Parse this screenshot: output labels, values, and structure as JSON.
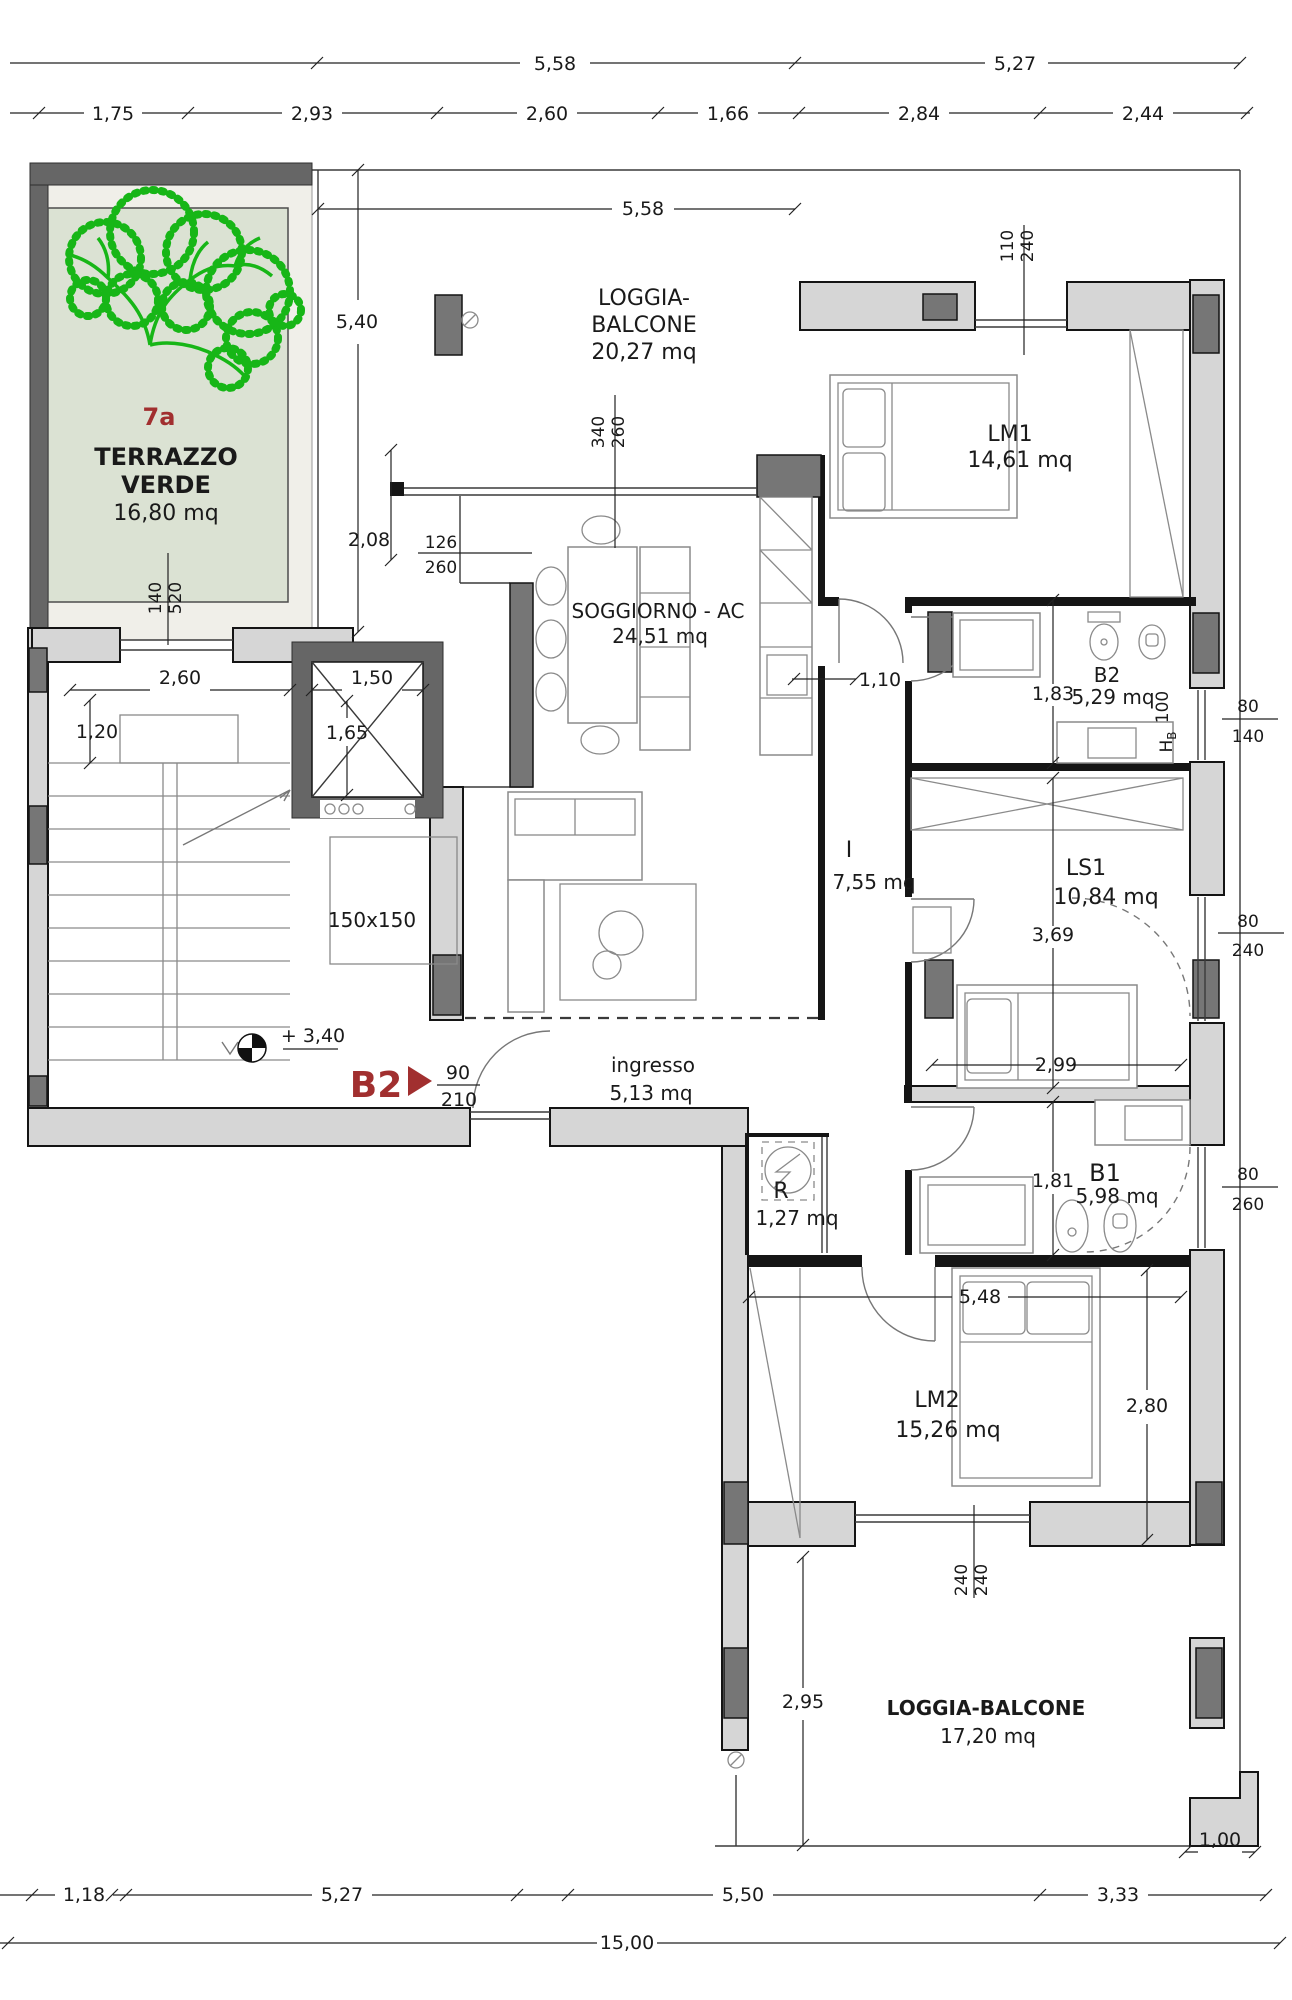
{
  "plan": {
    "unit": {
      "id": "7a"
    },
    "entry": {
      "label": "B2",
      "width": "90",
      "height": "210"
    },
    "level": {
      "value": "+ 3,40"
    },
    "landing": {
      "size": "150x150"
    },
    "rooms": {
      "terrazzo": {
        "id": "7a",
        "line1": "TERRAZZO",
        "line2": "VERDE",
        "area": "16,80 mq"
      },
      "loggia_top": {
        "line1": "LOGGIA-",
        "line2": "BALCONE",
        "area": "20,27 mq"
      },
      "lm1": {
        "name": "LM1",
        "area": "14,61 mq"
      },
      "soggiorno": {
        "name": "SOGGIORNO - AC",
        "area": "24,51 mq"
      },
      "b2": {
        "name": "B2",
        "area": "5,29 mq"
      },
      "corridoio": {
        "name": "I",
        "area": "7,55 mq"
      },
      "ls1": {
        "name": "LS1",
        "area": "10,84 mq"
      },
      "ingresso": {
        "name": "ingresso",
        "area": "5,13 mq"
      },
      "r": {
        "name": "R",
        "area": "1,27 mq"
      },
      "b1": {
        "name": "B1",
        "area": "5,98 mq"
      },
      "lm2": {
        "name": "LM2",
        "area": "15,26 mq"
      },
      "loggia_bottom": {
        "name": "LOGGIA-BALCONE",
        "area": "17,20 mq"
      }
    },
    "dims": {
      "top1": [
        "5,58",
        "5,27"
      ],
      "top2": [
        "1,75",
        "2,93",
        "2,60",
        "1,66",
        "2,84",
        "2,44"
      ],
      "bottom1": [
        "1,18",
        "5,27",
        "5,50",
        "3,33"
      ],
      "total": "15,00",
      "loggia_w": "5,58",
      "terrace_h": "5,40",
      "d208": "2,08",
      "stair_w": "2,60",
      "stair_h": "1,20",
      "elev_w": "1,50",
      "elev_h": "1,65",
      "d110": "1,10",
      "d183": "1,83",
      "d369": "3,69",
      "d299": "2,99",
      "d181": "1,81",
      "d548": "5,48",
      "d280": "2,80",
      "d295": "2,95",
      "d100": "1,00"
    },
    "windows": {
      "w140_520": {
        "a": "140",
        "b": "520"
      },
      "w340_260": {
        "a": "340",
        "b": "260"
      },
      "w126_260": {
        "a": "126",
        "b": "260"
      },
      "w110_240": {
        "a": "110",
        "b": "240"
      },
      "w80_140": {
        "a": "80",
        "b": "140"
      },
      "w80_240": {
        "a": "80",
        "b": "240"
      },
      "w80_260": {
        "a": "80",
        "b": "260"
      },
      "w240_240": {
        "a": "240",
        "b": "240"
      },
      "hb": {
        "h": "H",
        "sub": "B",
        "val": "100"
      }
    },
    "colors": {
      "wall_light": "#d6d6d6",
      "wall_dark": "#767676",
      "terrace_wall": "#666666",
      "green_fill": "#dbe2d3",
      "tree_green": "#17b617",
      "accent_red": "#a12f2f",
      "line": "#1a1a1a"
    }
  }
}
